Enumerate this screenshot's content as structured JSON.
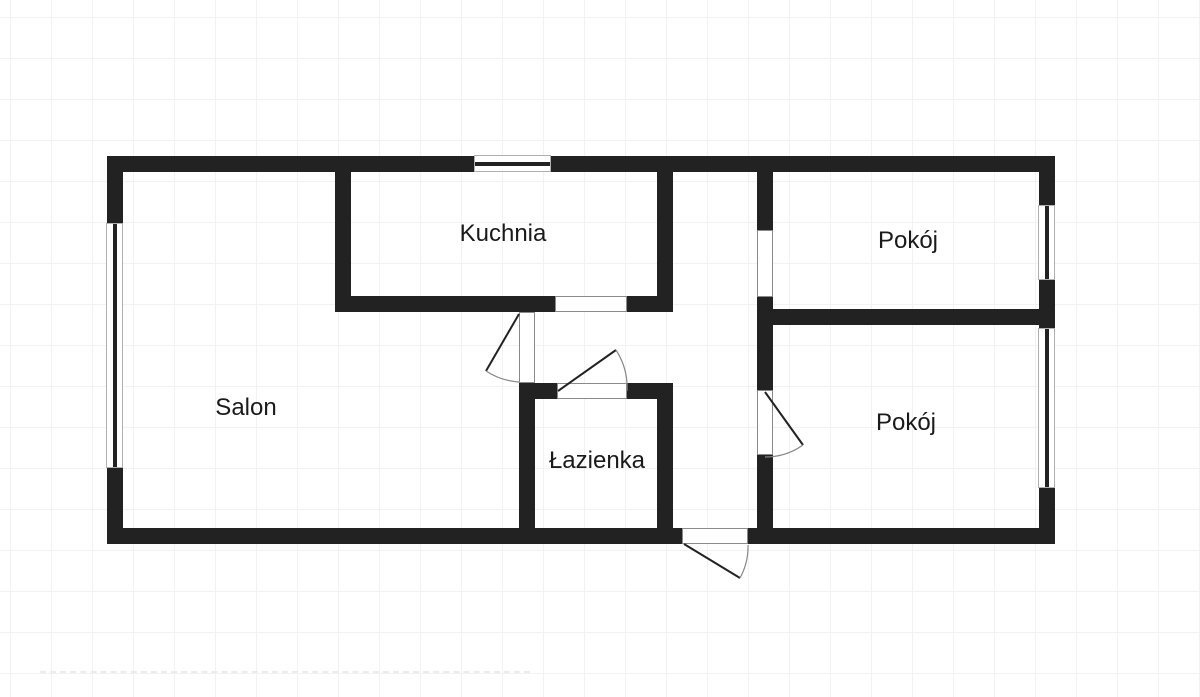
{
  "plan": {
    "rooms": {
      "salon": {
        "label": "Salon"
      },
      "kuchnia": {
        "label": "Kuchnia"
      },
      "lazienka": {
        "label": "Łazienka"
      },
      "pokoj_top": {
        "label": "Pokój"
      },
      "pokoj_bottom": {
        "label": "Pokój"
      }
    },
    "colors": {
      "wall": "#222222",
      "background": "#ffffff",
      "grid": "#f2f2f2",
      "text": "#1a1a1a",
      "arc": "#888888"
    }
  }
}
